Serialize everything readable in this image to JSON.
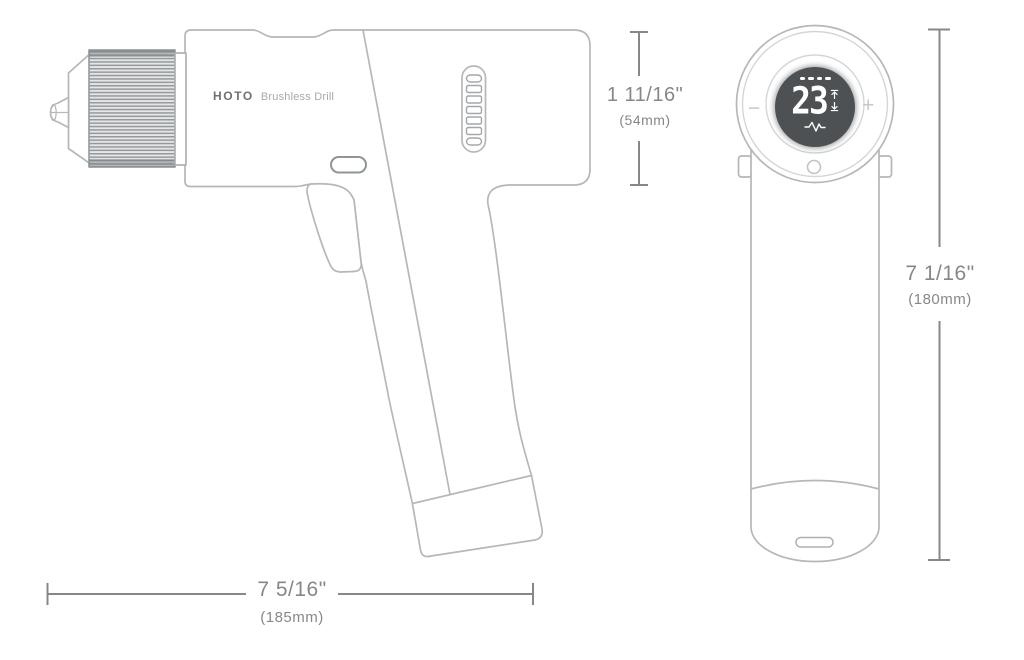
{
  "product": {
    "brand": "HOTO",
    "name": "Brushless Drill"
  },
  "display": {
    "value": "23",
    "minus_label": "−",
    "plus_label": "+",
    "battery_segments": 4,
    "icons": [
      "battery-level-dots",
      "torque-up-icon",
      "torque-down-icon",
      "vibration-wave-icon"
    ]
  },
  "dimensions": {
    "head_height": {
      "inches": "1 11/16\"",
      "metric": "(54mm)"
    },
    "length": {
      "inches": "7 5/16\"",
      "metric": "(185mm)"
    },
    "total_height": {
      "inches": "7 1/16\"",
      "metric": "(180mm)"
    }
  },
  "colors": {
    "background": "#ffffff",
    "outline": "#b4b8ba",
    "dimension_lines": "#85888b",
    "dimension_text": "#84888b",
    "brand_text": "#6e7275",
    "product_text": "#a6aaad",
    "display_background": "#4d5154",
    "display_text": "#ffffff",
    "plus_minus": "#c5c8ca"
  }
}
